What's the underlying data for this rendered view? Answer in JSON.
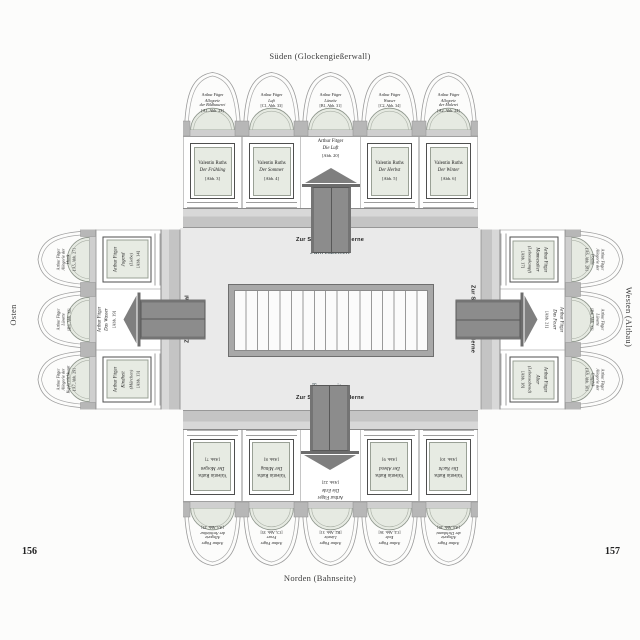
{
  "page": {
    "left_number": "156",
    "right_number": "157"
  },
  "compass": {
    "south": "Süden (Glockengießerwall)",
    "north": "Norden (Bahnseite)",
    "east": "Osten",
    "west": "Westen (Altbau)"
  },
  "center": {
    "top_link": "Zur Sammlung Moderne",
    "top_cycle": "Jahreszeiten",
    "bottom_cycle": "Tageszeiten",
    "bottom_link": "Zur Sammlung Moderne",
    "left_link": "Zum Makart-Saal",
    "left_cycle": "Lebensalter",
    "right_link": "Zur Sammlung Moderne",
    "right_cycle": "Lebensalter"
  },
  "walls": {
    "south": {
      "lunettes": [
        {
          "artist": "Arthur Fitger",
          "title": "Allegorie\nder Bildhauerei",
          "ref": "[A1, Abb. 23]"
        },
        {
          "artist": "Arthur Fitger",
          "title": "Luft",
          "ref": "[C1, Abb. 33]"
        },
        {
          "artist": "Arthur Fitger",
          "title": "Lünette",
          "ref": "[B1, Abb. 31]"
        },
        {
          "artist": "Arthur Fitger",
          "title": "Wasser",
          "ref": "[C2, Abb. 34]"
        },
        {
          "artist": "Arthur Fitger",
          "title": "Allegorie\nder Malerei",
          "ref": "[A2, Abb. 24]"
        }
      ],
      "bays": [
        {
          "type": "panel",
          "artist": "Valentin Ruths",
          "title": "Der Frühling",
          "ref": "[Abb. 3]"
        },
        {
          "type": "panel",
          "artist": "Valentin Ruths",
          "title": "Der Sommer",
          "ref": "[Abb. 4]"
        },
        {
          "type": "door",
          "artist": "Arthur Fitger",
          "title": "Die Luft",
          "ref": "[Abb. 20]"
        },
        {
          "type": "panel",
          "artist": "Valentin Ruths",
          "title": "Der Herbst",
          "ref": "[Abb. 5]"
        },
        {
          "type": "panel",
          "artist": "Valentin Ruths",
          "title": "Der Winter",
          "ref": "[Abb. 6]"
        }
      ]
    },
    "north": {
      "lunettes": [
        {
          "artist": "Arthur Fitger",
          "title": "Allegorie\nder Architektur",
          "ref": "[A3, Abb. 25]"
        },
        {
          "artist": "Arthur Fitger",
          "title": "Feuer",
          "ref": "[C3, Abb. 35]"
        },
        {
          "artist": "Arthur Fitger",
          "title": "Lünette",
          "ref": "[B2, Abb. 31]"
        },
        {
          "artist": "Arthur Fitger",
          "title": "Erde",
          "ref": "[C4, Abb. 36]"
        },
        {
          "artist": "Arthur Fitger",
          "title": "Allegorie\nder Dichtkunst",
          "ref": "[A4, Abb. 26]"
        }
      ],
      "bays": [
        {
          "type": "panel",
          "artist": "Valentin Ruths",
          "title": "Der Morgen",
          "ref": "[Abb. 7]"
        },
        {
          "type": "panel",
          "artist": "Valentin Ruths",
          "title": "Der Mittag",
          "ref": "[Abb. 8]"
        },
        {
          "type": "door",
          "artist": "Arthur Fitger",
          "title": "Die Erde",
          "ref": "[Abb. 22]"
        },
        {
          "type": "panel",
          "artist": "Valentin Ruths",
          "title": "Der Abend",
          "ref": "[Abb. 9]"
        },
        {
          "type": "panel",
          "artist": "Valentin Ruths",
          "title": "Die Nacht",
          "ref": "[Abb. 10]"
        }
      ]
    },
    "east": {
      "lunettes": [
        {
          "artist": "Arthur Fitger",
          "title": "Allegorie der\nMusik",
          "ref": "[A5, Abb. 27]"
        },
        {
          "artist": "Arthur Fitger",
          "title": "Lünette",
          "ref": "[B3, Abb. 32]"
        },
        {
          "artist": "Arthur Fitger",
          "title": "Allegorie der\nKupferstichkunst",
          "ref": "[A7, Abb. 29]"
        }
      ],
      "bays": [
        {
          "type": "panel",
          "artist": "Arthur Fitger",
          "title": "Jugend",
          "sub": "(Liebe)",
          "ref": "[Abb. 14]"
        },
        {
          "type": "door",
          "artist": "Arthur Fitger",
          "title": "Das Wasser",
          "ref": "[Abb. 19]"
        },
        {
          "type": "panel",
          "artist": "Arthur Fitger",
          "title": "Kindheit",
          "sub": "(Märchen)",
          "ref": "[Abb. 13]"
        }
      ]
    },
    "west": {
      "lunettes": [
        {
          "artist": "Arthur Fitger",
          "title": "Allegorie der\nPoesie",
          "ref": "[A6, Abb. 28]"
        },
        {
          "artist": "Arthur Fitger",
          "title": "Lünette",
          "ref": "[B4, Abb. 32]"
        },
        {
          "artist": "Arthur Fitger",
          "title": "Allegorie der\nGraphik",
          "ref": "[A8, Abb. 30]"
        }
      ],
      "bays": [
        {
          "type": "panel",
          "artist": "Arthur Fitger",
          "title": "Mannesalter",
          "sub": "(Lebenskampf)",
          "ref": "[Abb. 17]"
        },
        {
          "type": "door",
          "artist": "Arthur Fitger",
          "title": "Das Feuer",
          "ref": "[Abb. 21]"
        },
        {
          "type": "panel",
          "artist": "Arthur Fitger",
          "title": "Alter",
          "sub": "(Lebensabend)",
          "ref": "[Abb. 18]"
        }
      ]
    }
  },
  "colors": {
    "panel_fill": "#e7ebe3",
    "wall_band": "#c6c6c6",
    "door_gray": "#8c8c8c",
    "floor": "#eaeaea",
    "cycle_text": "#3c4e52"
  }
}
